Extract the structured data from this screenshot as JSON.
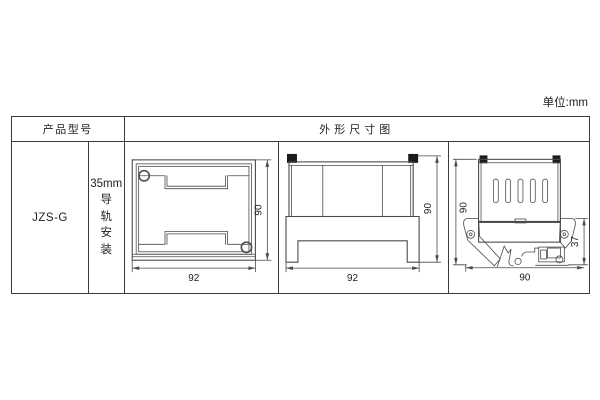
{
  "unit_label": "单位:mm",
  "table": {
    "header": {
      "product_model": "产品型号",
      "dimension_title": "外形尺寸图"
    },
    "model": "JZS-G",
    "mounting": {
      "size": "35mm",
      "char_1": "导",
      "char_2": "轨",
      "char_3": "安",
      "char_4": "装"
    }
  },
  "drawings": {
    "top_view": {
      "width_label": "92",
      "height_label": "90"
    },
    "front_view": {
      "width_label": "92",
      "height_label": "90"
    },
    "side_view": {
      "height_label": "90",
      "depth_label": "37",
      "width_label": "90"
    }
  },
  "colors": {
    "line": "#4a4a4a",
    "border": "#3c3c3c",
    "text": "#222222",
    "ear": "#1c1c1c"
  }
}
